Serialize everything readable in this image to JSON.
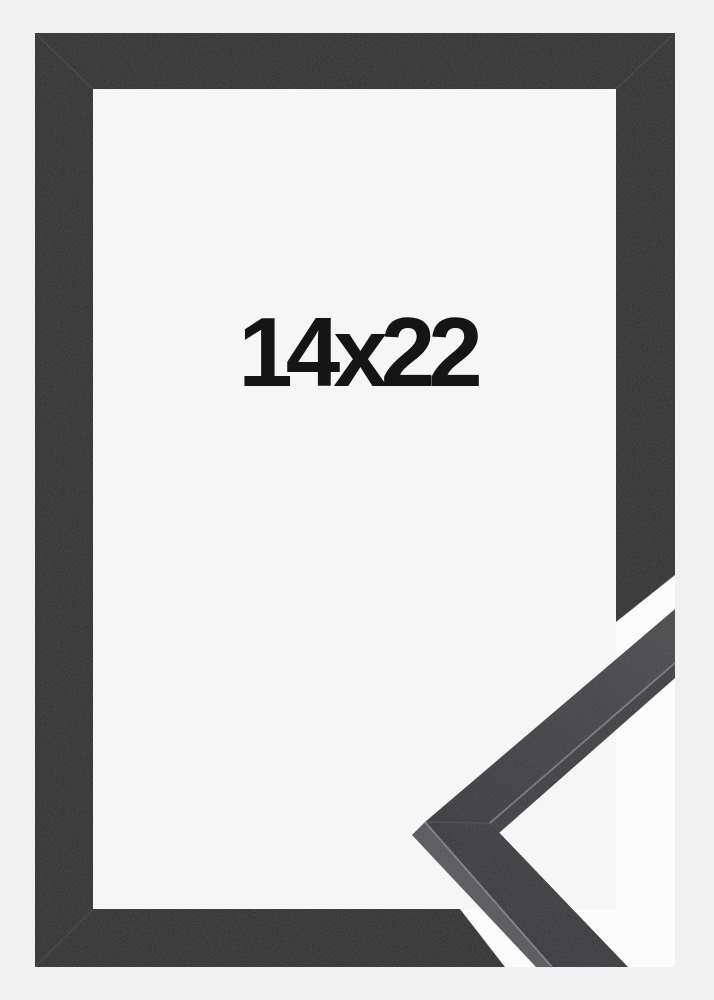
{
  "product": {
    "size_label": "14x22"
  },
  "colors": {
    "page_background": "#f0f1f0",
    "frame_opening": "#f5f6f5",
    "notch_gap": "#fafbfa",
    "frame_moulding": "#2b2b2b",
    "sample_front_light": "#47474a",
    "sample_front_dark": "#323235",
    "sample_side_outer": "#56565b",
    "sample_side_inner": "#3a3a3d",
    "edge_highlight": "#8d8d91",
    "miter_line": "#ffffff",
    "label_text": "#151515"
  }
}
